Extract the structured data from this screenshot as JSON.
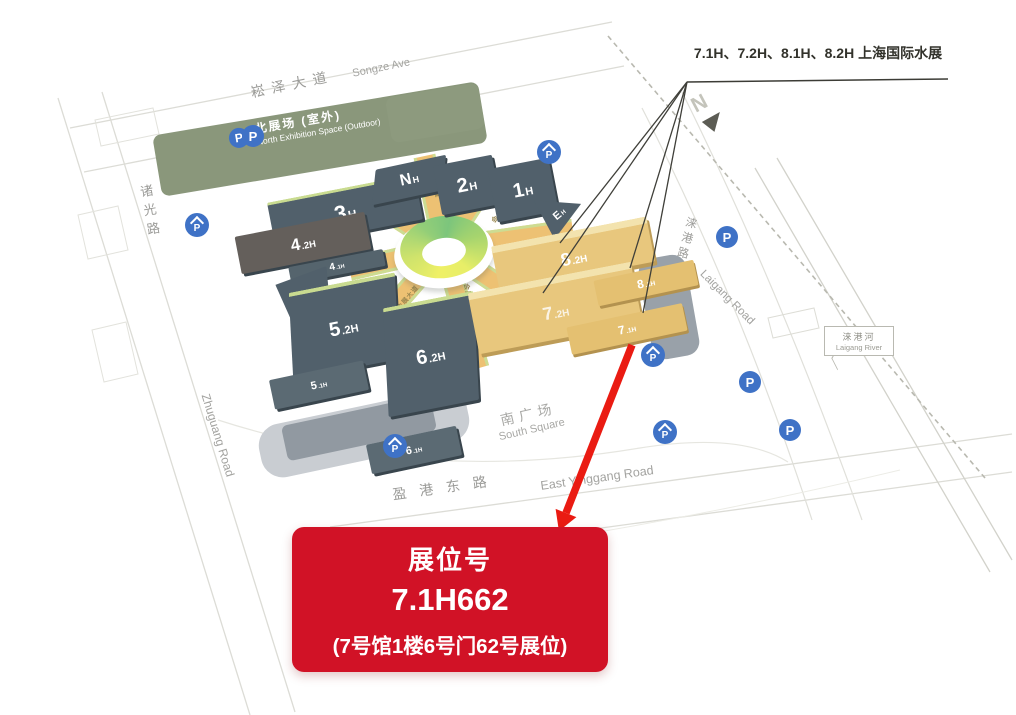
{
  "annotation": {
    "halls_text": "7.1H、7.2H、8.1H、8.2H 上海国际水展"
  },
  "booth_card": {
    "title": "展位号",
    "booth_number": "7.1H662",
    "detail": "(7号馆1楼6号门62号展位)"
  },
  "map": {
    "north_label": "N",
    "parking_letter": "P",
    "ring_road_label": "会展大道",
    "areas": {
      "north_space_zh": "北展场 (室外)",
      "north_space_en": "North Exhibition Space (Outdoor)",
      "south_square_zh": "南广场",
      "south_square_en": "South Square"
    },
    "roads": {
      "songze_zh": "崧泽大道",
      "songze_en": "Songze Ave",
      "zhuguang_zh": "诸光路",
      "zhuguang_en": "Zhuguang Road",
      "yinggang_zh": "盈港东路",
      "yinggang_en": "East Yinggang Road",
      "laigang_road_zh": "涞港路",
      "laigang_road_en": "Laigang Road",
      "laigang_river_zh": "涞港河",
      "laigang_river_en": "Laigang River"
    },
    "halls": [
      {
        "id": "3H",
        "big": "3",
        "small": "H"
      },
      {
        "id": "4.2H",
        "big": "4",
        "small": ".2H"
      },
      {
        "id": "4.1H",
        "big": "4",
        "small": ".1H"
      },
      {
        "id": "NH",
        "big": "N",
        "small": "H"
      },
      {
        "id": "2H",
        "big": "2",
        "small": "H"
      },
      {
        "id": "1H",
        "big": "1",
        "small": "H"
      },
      {
        "id": "EH",
        "big": "E",
        "small": "H"
      },
      {
        "id": "WH",
        "big": "W",
        "small": "H"
      },
      {
        "id": "5.2H",
        "big": "5",
        "small": ".2H"
      },
      {
        "id": "5.1H",
        "big": "5",
        "small": ".1H"
      },
      {
        "id": "6.2H",
        "big": "6",
        "small": ".2H"
      },
      {
        "id": "6.1H",
        "big": "6",
        "small": ".1H"
      },
      {
        "id": "8.2H",
        "big": "8",
        "small": ".2H"
      },
      {
        "id": "8.1H",
        "big": "8",
        "small": ".1H"
      },
      {
        "id": "7.2H",
        "big": "7",
        "small": ".2H"
      },
      {
        "id": "7.1H",
        "big": "7",
        "small": ".1H"
      }
    ],
    "colors": {
      "highlight_hall": "#e8c77d",
      "regular_hall": "#51606b",
      "green_space": "#8a977b",
      "booth_card_red": "#d11226",
      "arrow_red": "#ea1b12",
      "parking_blue": "#3f72c6"
    }
  }
}
